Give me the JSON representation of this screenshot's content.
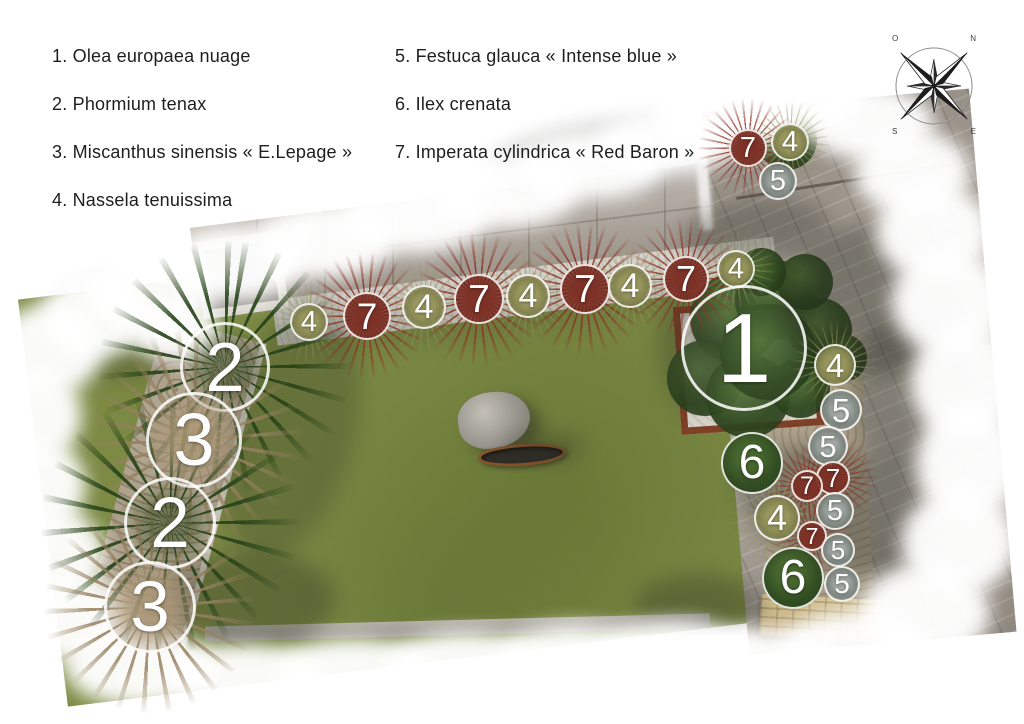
{
  "legend": {
    "items": [
      "1. Olea europaea nuage",
      "2. Phormium tenax",
      "3. Miscanthus sinensis « E.Lepage »",
      "4. Nassela tenuissima",
      "5. Festuca glauca « Intense blue »",
      "6. Ilex crenata",
      "7. Imperata cylindrica « Red Baron »"
    ]
  },
  "compass": {
    "nw": "O",
    "ne": "N",
    "se": "E",
    "sw": "S"
  },
  "colors": {
    "lawn_green": "#7d8b45",
    "imperata_red": "#6d2b22",
    "ilex_green": "#2a411d",
    "corten_rust": "#7e4026",
    "gravel": "#d6d5cd",
    "paving_gray": "#a39b90",
    "wall_beige": "#c9b585",
    "marker_ring": "#ffffff"
  },
  "markers": [
    {
      "label": "4",
      "x": 309,
      "y": 322,
      "r": 19,
      "plant": "nassella"
    },
    {
      "label": "7",
      "x": 367,
      "y": 316,
      "r": 24,
      "plant": "imperata"
    },
    {
      "label": "4",
      "x": 424,
      "y": 307,
      "r": 22,
      "plant": "nassella"
    },
    {
      "label": "7",
      "x": 479,
      "y": 299,
      "r": 25,
      "plant": "imperata"
    },
    {
      "label": "4",
      "x": 528,
      "y": 296,
      "r": 22,
      "plant": "nassella"
    },
    {
      "label": "7",
      "x": 585,
      "y": 289,
      "r": 25,
      "plant": "imperata"
    },
    {
      "label": "4",
      "x": 630,
      "y": 286,
      "r": 22,
      "plant": "nassella"
    },
    {
      "label": "7",
      "x": 686,
      "y": 279,
      "r": 23,
      "plant": "imperata"
    },
    {
      "label": "4",
      "x": 736,
      "y": 269,
      "r": 19,
      "plant": "nassella"
    },
    {
      "label": "7",
      "x": 748,
      "y": 148,
      "r": 19,
      "plant": "imperata"
    },
    {
      "label": "4",
      "x": 790,
      "y": 142,
      "r": 19,
      "plant": "nassella"
    },
    {
      "label": "5",
      "x": 778,
      "y": 181,
      "r": 19,
      "plant": "festuca"
    },
    {
      "label": "1",
      "x": 744,
      "y": 348,
      "r": 63,
      "plant": "olea"
    },
    {
      "label": "6",
      "x": 752,
      "y": 463,
      "r": 31,
      "plant": "ilex"
    },
    {
      "label": "4",
      "x": 835,
      "y": 365,
      "r": 21,
      "plant": "nassella"
    },
    {
      "label": "5",
      "x": 841,
      "y": 410,
      "r": 21,
      "plant": "festuca"
    },
    {
      "label": "5",
      "x": 828,
      "y": 446,
      "r": 20,
      "plant": "festuca"
    },
    {
      "label": "7",
      "x": 833,
      "y": 478,
      "r": 17,
      "plant": "imperata"
    },
    {
      "label": "7",
      "x": 807,
      "y": 486,
      "r": 16,
      "plant": "imperata"
    },
    {
      "label": "5",
      "x": 835,
      "y": 511,
      "r": 19,
      "plant": "festuca"
    },
    {
      "label": "4",
      "x": 777,
      "y": 518,
      "r": 23,
      "plant": "nassella"
    },
    {
      "label": "7",
      "x": 812,
      "y": 536,
      "r": 15,
      "plant": "imperata"
    },
    {
      "label": "5",
      "x": 838,
      "y": 550,
      "r": 17,
      "plant": "festuca"
    },
    {
      "label": "6",
      "x": 793,
      "y": 578,
      "r": 31,
      "plant": "ilex"
    },
    {
      "label": "5",
      "x": 842,
      "y": 584,
      "r": 18,
      "plant": "festuca"
    },
    {
      "label": "2",
      "x": 225,
      "y": 367,
      "r": 45,
      "plant": "phormium"
    },
    {
      "label": "3",
      "x": 194,
      "y": 440,
      "r": 48,
      "plant": "miscanthus"
    },
    {
      "label": "2",
      "x": 170,
      "y": 523,
      "r": 46,
      "plant": "phormium"
    },
    {
      "label": "3",
      "x": 150,
      "y": 607,
      "r": 46,
      "plant": "miscanthus"
    }
  ]
}
